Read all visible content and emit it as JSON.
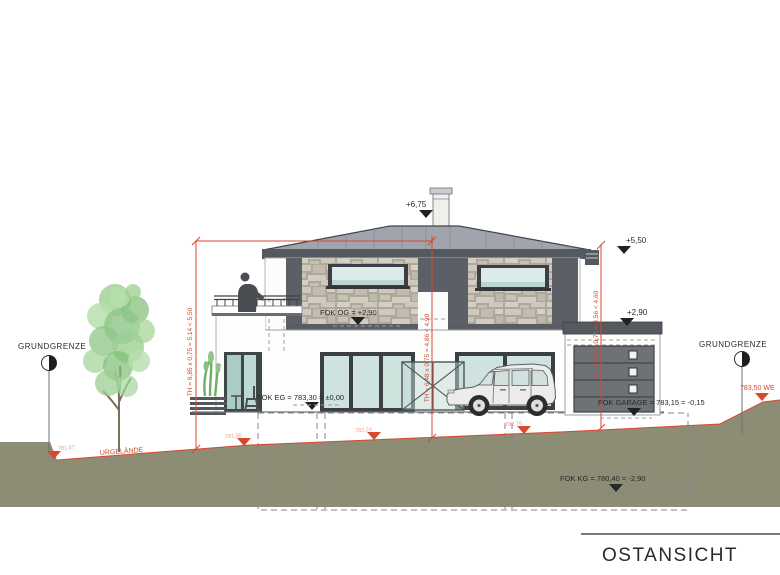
{
  "drawing": {
    "title": "OSTANSICHT",
    "boundaries": {
      "left": "GRUNDGRENZE",
      "right": "GRUNDGRENZE"
    },
    "terrain": {
      "line_label": "URGELÄNDE",
      "left_level": "781,57",
      "spot_levels": [
        "781,95",
        "782,24",
        "782,76"
      ],
      "path_level": "783,50 WE"
    },
    "levels": {
      "ridge": "+6,75",
      "eave": "+5,50",
      "garage_top": "+2,90",
      "fok_og": "FOK OG = +2,90",
      "fok_eg": "FOK EG = 783,30 = ±0,00",
      "fok_garage": "FOK GARAGE = 783,15 = -0,15",
      "fok_kg": "FOK KG = 780,40 = -2,90"
    },
    "dimensions": {
      "left": "TH = 6,85 x 0,75 = 5,14 < 5,50",
      "middle": "TH = 6,48 x 0,75 = 4,86 < 4,90",
      "right": "TH = 6,08 x 0,75 = 4,56 < 4,60"
    },
    "colors": {
      "annotation_red": "#d9472e",
      "terrain_fill": "#8d8d76",
      "roof_gray": "#a1a4ac",
      "trim_dark": "#585c63",
      "stone_beige": "#c8c2b6",
      "glass_teal": "#cfe3de",
      "tree_green": "#8fc588"
    }
  }
}
